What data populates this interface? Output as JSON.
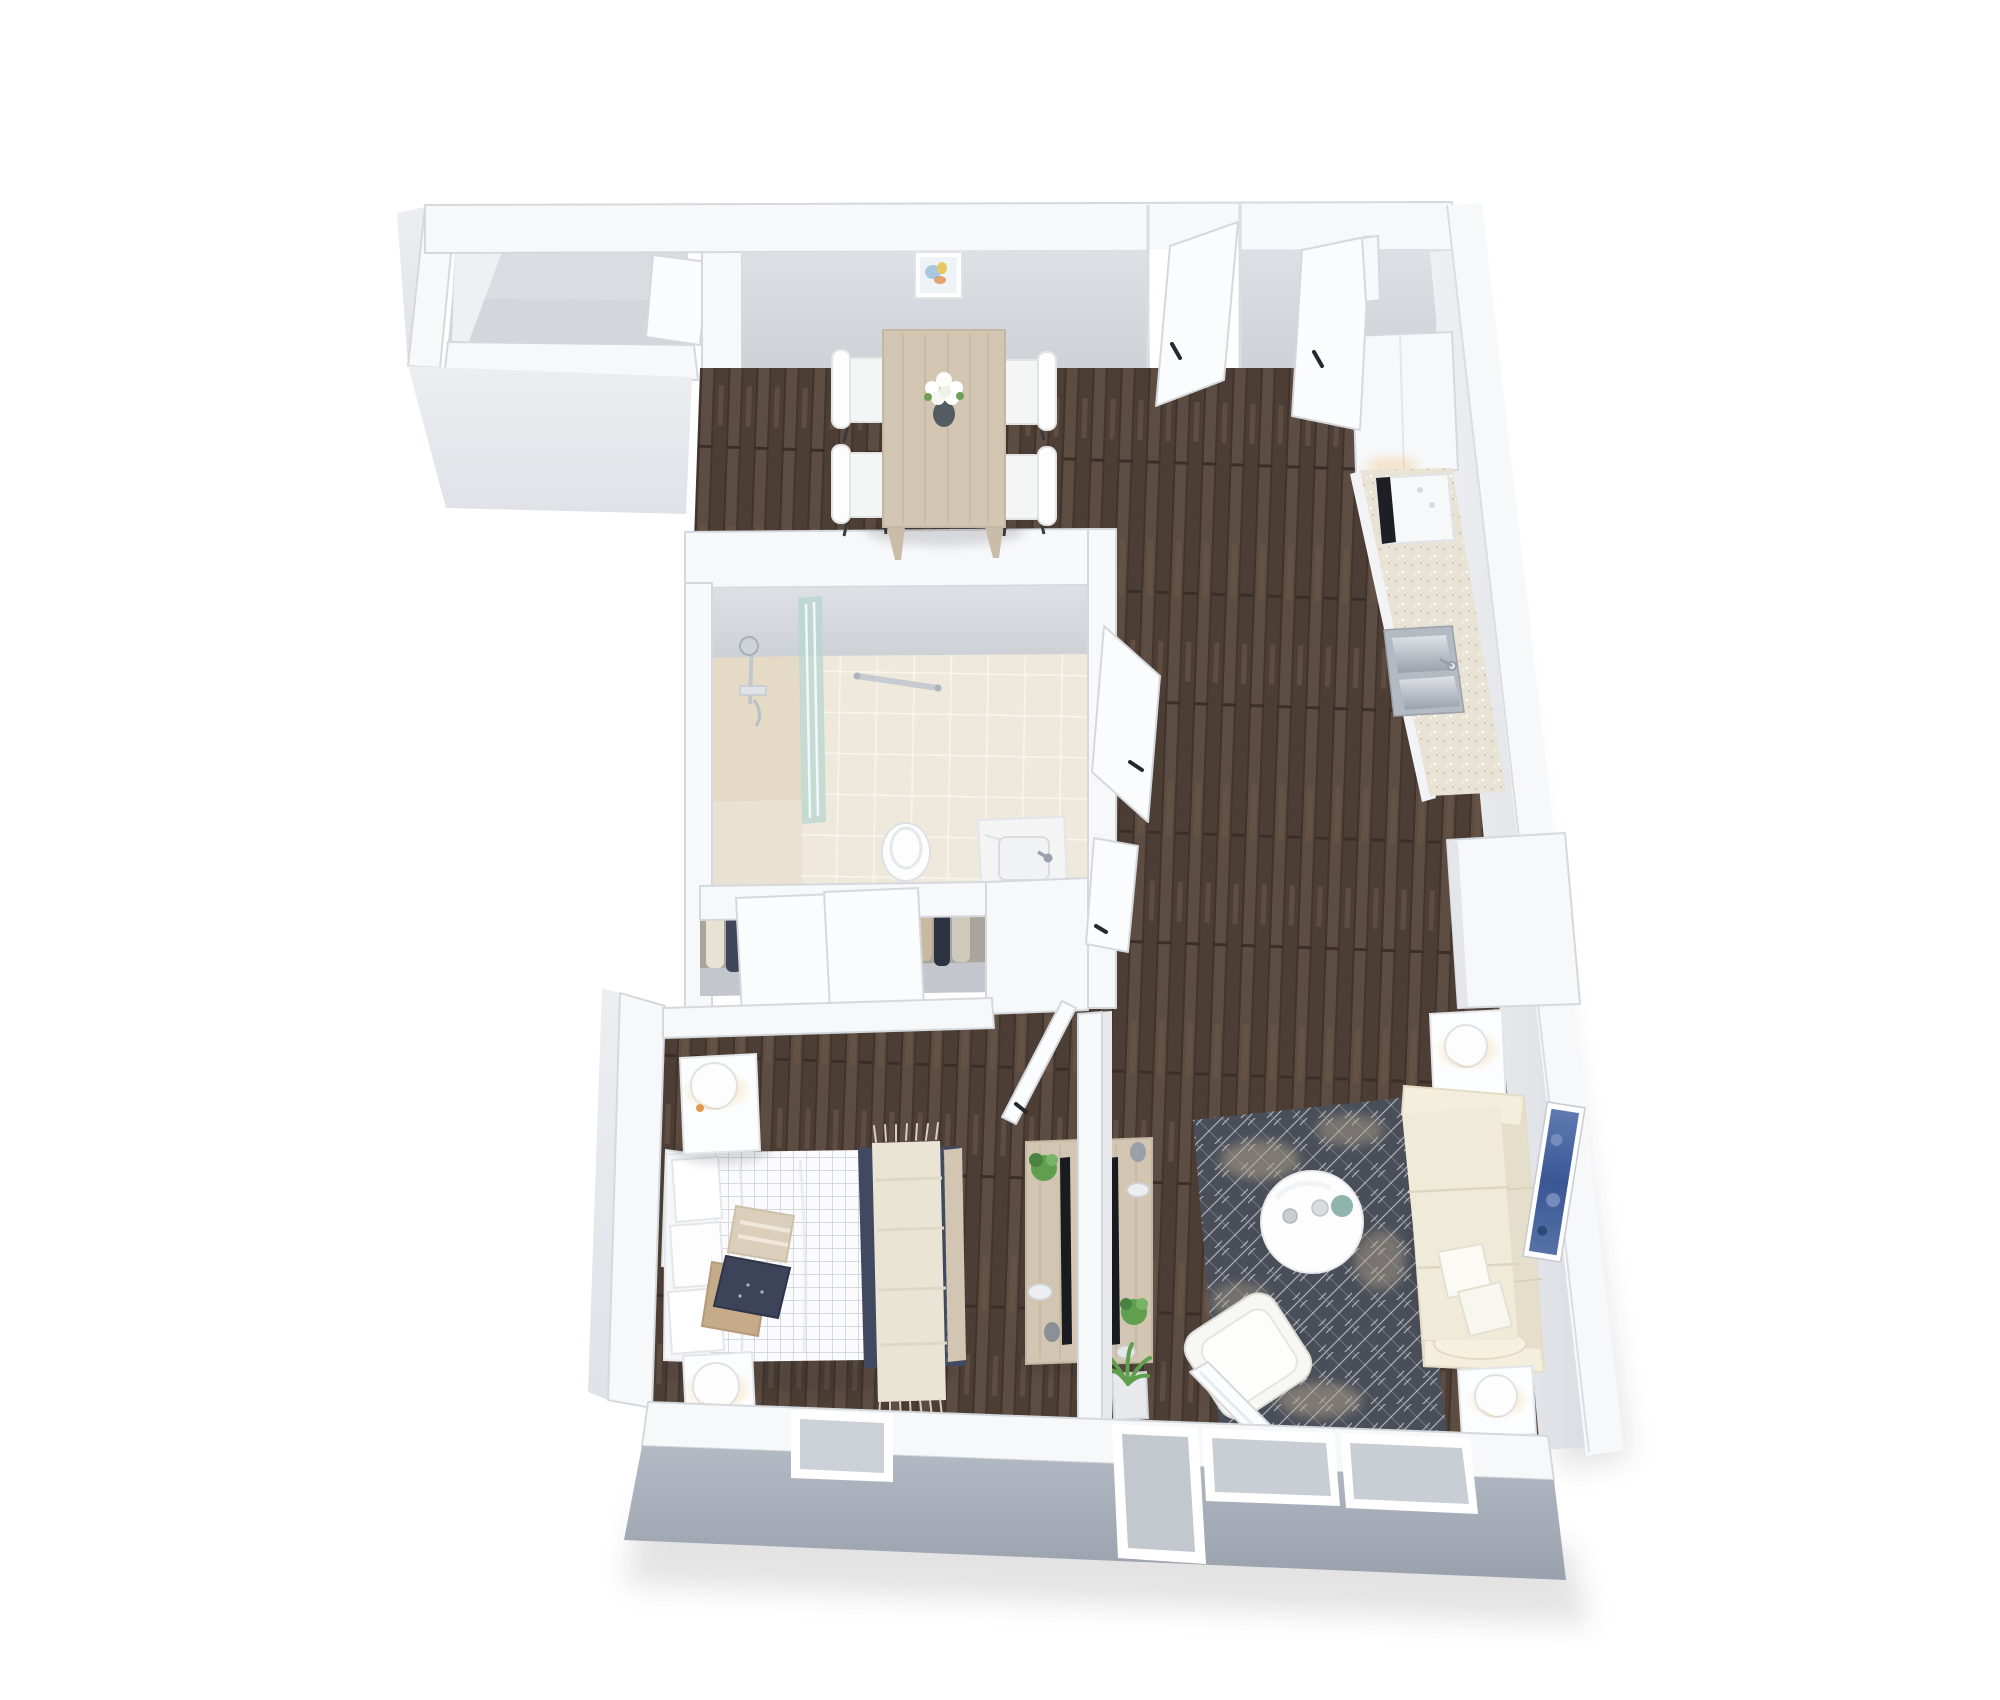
{
  "meta": {
    "kind": "3d-floor-plan-render",
    "view": "isometric-top-down",
    "visible_text": ""
  },
  "palette": {
    "page_bg": "#ffffff",
    "wall_white": "#f7f8fa",
    "door_white": "#fbfcfd",
    "wall_outline": "#d5d8dd",
    "wall_face_top": "#dde0e4",
    "wall_face_bottom": "#cdd1d6",
    "east_face_light": "#eef0f3",
    "east_face_dark": "#d8dbe0",
    "exterior_gray_top": "#b4bac4",
    "exterior_gray_bottom": "#9aa1ad",
    "exterior_light": "#eceef1",
    "balcony_floor": "#d3d6db",
    "wood_base": "#5d4c41",
    "wood_dark": "#4c3e35",
    "wood_light": "#6f5b4c",
    "grain": "#c2b49e",
    "tile": "#efe9dc",
    "grout": "#f8f5ee",
    "shower_floor": "#e4dac6",
    "glass_teal": "#b7d6cf",
    "rug_base": "#494e59",
    "rug_line": "#ffffff",
    "rug_blotch": "#b4a48e",
    "sofa": "#efe8d5",
    "sofa_shade": "#e5deca",
    "sofa_arm": "#f4eedd",
    "duvet": "#fbfbfd",
    "navy": "#414960",
    "cream_throw": "#e9e4d4",
    "tan_pillow": "#c6ab8b",
    "beige_pillow": "#dbcfbb",
    "furniture_wood": "#d2c6b2",
    "chair_white": "#f4f5f5",
    "steel": "#b7bdc5",
    "marble": "#f4f4f5",
    "tv_black": "#191b20",
    "lamp_glow": "#f0bc77",
    "plant_green": "#5f9f4e",
    "plant_dark": "#4a8340",
    "art_blue": "#5671a6",
    "art_blue_dark": "#32508e",
    "counter": "#e8e3d5",
    "vase_dark": "#555b63",
    "clothes": [
      "#e8e2d4",
      "#3f4659",
      "#c3a987",
      "#2e3342",
      "#8e939e",
      "#d9d3c6",
      "#49506a",
      "#b59a78",
      "#23283a",
      "#dad4c8"
    ]
  },
  "scene": {
    "rooms": [
      {
        "name": "balcony",
        "position": "top-left",
        "furniture": []
      },
      {
        "name": "dining-area",
        "position": "top-center",
        "furniture": [
          "dining-table",
          "dining-chair x4",
          "flower-centerpiece",
          "framed-wall-picture"
        ]
      },
      {
        "name": "kitchen",
        "position": "top-right",
        "furniture": [
          "tall-cabinet",
          "range",
          "countertop",
          "double-sink"
        ]
      },
      {
        "name": "bathroom",
        "position": "center",
        "furniture": [
          "shower",
          "glass-screen",
          "towel-bar",
          "toilet",
          "vanity-sink"
        ]
      },
      {
        "name": "closet",
        "position": "center",
        "furniture": [
          "hanging-clothes",
          "sliding-door x2"
        ]
      },
      {
        "name": "hallway",
        "position": "center-right",
        "furniture": [
          "entry-door",
          "second-door",
          "bathroom-door",
          "linen-door"
        ]
      },
      {
        "name": "bedroom",
        "position": "bottom-left",
        "furniture": [
          "double-bed",
          "nightstand-with-lamp x2",
          "leaning-picture",
          "media-console-with-tv",
          "window",
          "door"
        ]
      },
      {
        "name": "living-room",
        "position": "bottom-right",
        "furniture": [
          "sofa",
          "throw-pillow x2",
          "coffee-table",
          "armchair",
          "area-rug",
          "side-table-with-lamp x2",
          "media-console-with-tv",
          "floor-plant",
          "blue-wall-art",
          "patio-door",
          "window x2"
        ]
      }
    ]
  }
}
